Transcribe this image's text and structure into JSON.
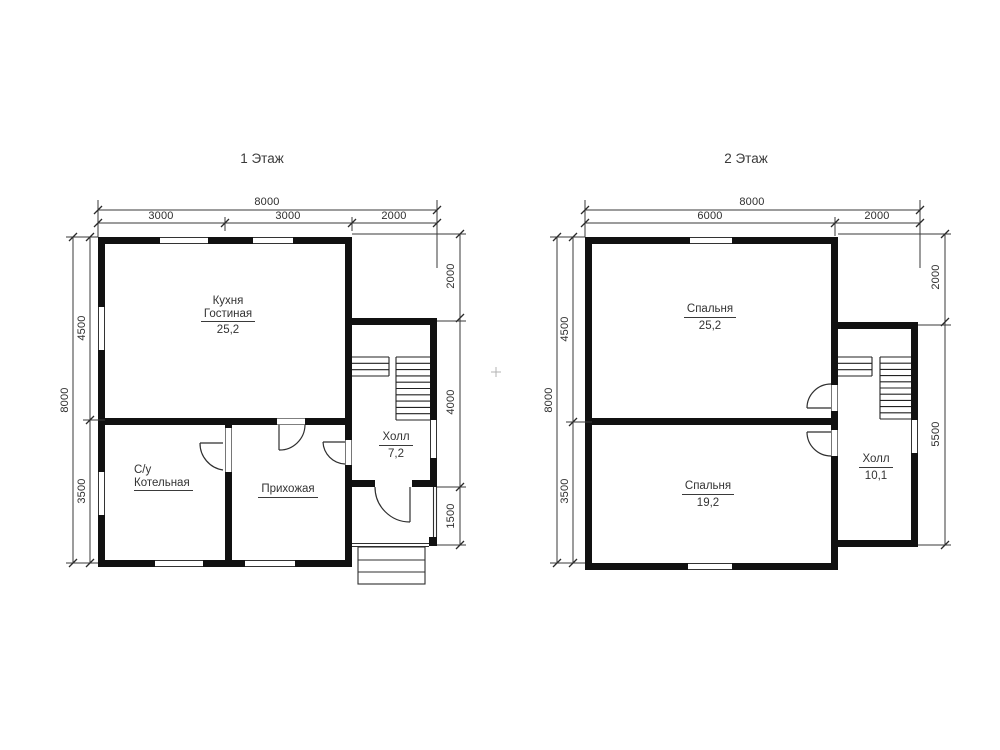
{
  "floors": {
    "floor1": {
      "title": "1 Этаж",
      "rooms": {
        "kitchen_living": {
          "line1": "Кухня",
          "line2": "Гостиная",
          "area": "25,2"
        },
        "boiler": {
          "line1": "С/у",
          "line2": "Котельная"
        },
        "hallway": {
          "name": "Прихожая"
        },
        "hall": {
          "name": "Холл",
          "area": "7,2"
        }
      },
      "dims": {
        "top_total": "8000",
        "top_segments": [
          "3000",
          "3000",
          "2000"
        ],
        "left_total": "8000",
        "left_segments": [
          "4500",
          "3500"
        ],
        "right_segments": [
          "2000",
          "4000",
          "1500"
        ]
      }
    },
    "floor2": {
      "title": "2 Этаж",
      "rooms": {
        "bedroom_upper": {
          "name": "Спальня",
          "area": "25,2"
        },
        "bedroom_lower": {
          "name": "Спальня",
          "area": "19,2"
        },
        "hall": {
          "name": "Холл",
          "area": "10,1"
        }
      },
      "dims": {
        "top_total": "8000",
        "top_segments": [
          "6000",
          "2000"
        ],
        "left_total": "8000",
        "left_segments": [
          "4500",
          "3500"
        ],
        "right_segments": [
          "2000",
          "5500"
        ]
      }
    }
  },
  "colors": {
    "wall": "#111111",
    "line": "#333333",
    "text": "#333333",
    "background": "#ffffff"
  }
}
